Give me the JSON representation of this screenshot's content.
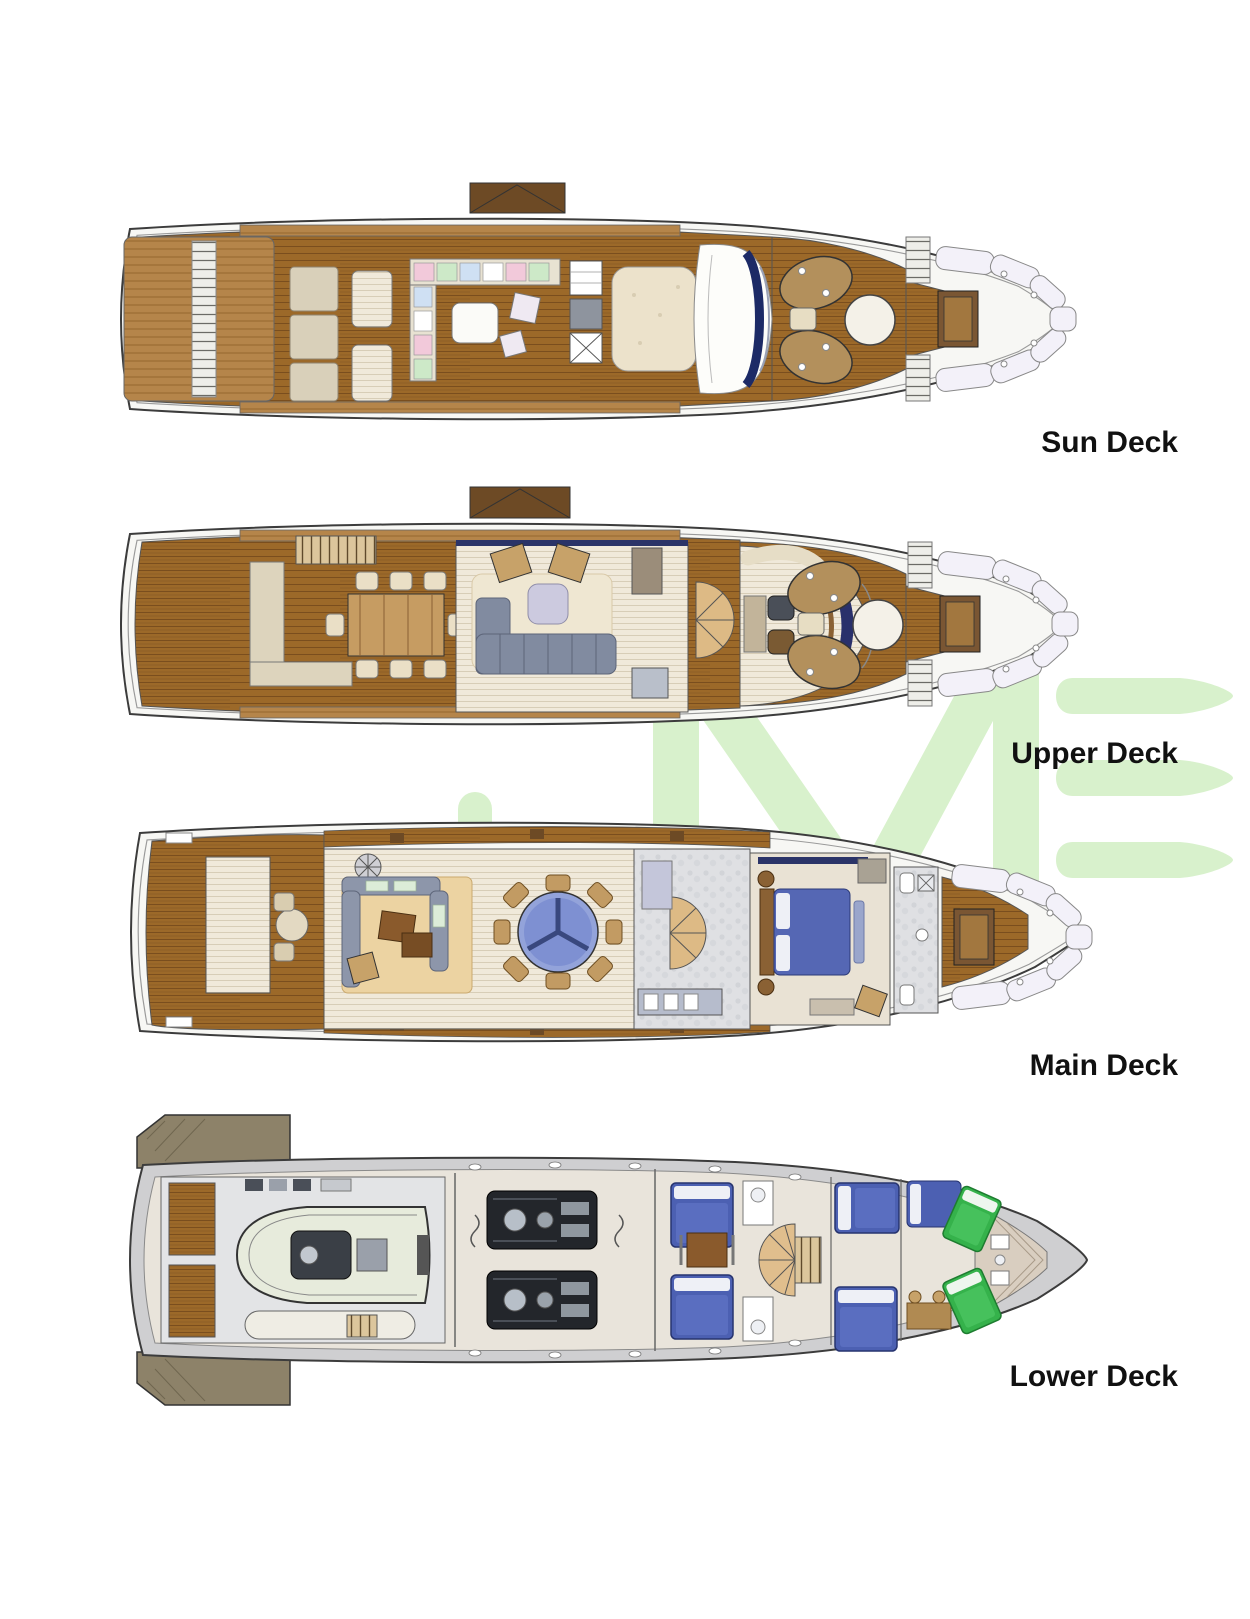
{
  "title": "Yacht general arrangement deck plans",
  "watermark": {
    "visible_letters": "ME",
    "color": "#d8f1cc"
  },
  "decks": [
    {
      "id": "sun-deck",
      "label": "Sun Deck",
      "features": [
        "mast-box",
        "stern-stairs",
        "sun-pads",
        "striped-loungers",
        "l-shaped-sofa",
        "bar-unit",
        "sun-bed",
        "glass-skylight",
        "windshield",
        "foredeck-lounge-pods",
        "foredeck-round-table",
        "bow-stairs",
        "bow-seating",
        "bow-table"
      ]
    },
    {
      "id": "upper-deck",
      "label": "Upper Deck",
      "features": [
        "mast-box",
        "aft-l-sofa",
        "dining-table-eight",
        "stair-hatch",
        "sky-lounge",
        "lounge-sofa",
        "armchairs",
        "coffee-table",
        "pantry-stairs",
        "wheelhouse",
        "helm-console",
        "captain-seats",
        "foredeck-lounge-pods",
        "foredeck-round-table",
        "bow-seating",
        "bow-table"
      ]
    },
    {
      "id": "main-deck",
      "label": "Main Deck",
      "features": [
        "transom-stairs",
        "aft-deck-table",
        "side-decks",
        "salon-sofa",
        "salon-rug",
        "coffee-tables",
        "round-dining-table",
        "dining-chairs",
        "spiral-staircase",
        "galley",
        "owner-stateroom",
        "owner-bed",
        "owner-bathroom",
        "foredeck",
        "bow-seating",
        "bow-table"
      ]
    },
    {
      "id": "lower-deck",
      "label": "Lower Deck",
      "features": [
        "stern-platform-flaps",
        "tender-garage",
        "tender",
        "jet-tender",
        "engine-room",
        "twin-engines",
        "crew-cabins",
        "crew-bunks",
        "crew-mess",
        "spiral-staircase",
        "guest-cabins",
        "guest-beds-blue",
        "vip-cabin",
        "crew-beds-green",
        "bathrooms",
        "bow-locker",
        "portholes"
      ]
    }
  ],
  "colors": {
    "teak": "#9c6929",
    "teak_light": "#b5854a",
    "hull_fill": "#f7f7f4",
    "hull_line": "#3c3c3c",
    "interior_floor": "#f0e9da",
    "sofa_gray": "#818ba0",
    "bed_blue": "#4c60b2",
    "bed_green": "#35b24b",
    "dining_table_blue": "#93a3da",
    "navy_accent": "#2b3468",
    "watermark_green": "#d8f1cc",
    "label_color": "#111111"
  }
}
